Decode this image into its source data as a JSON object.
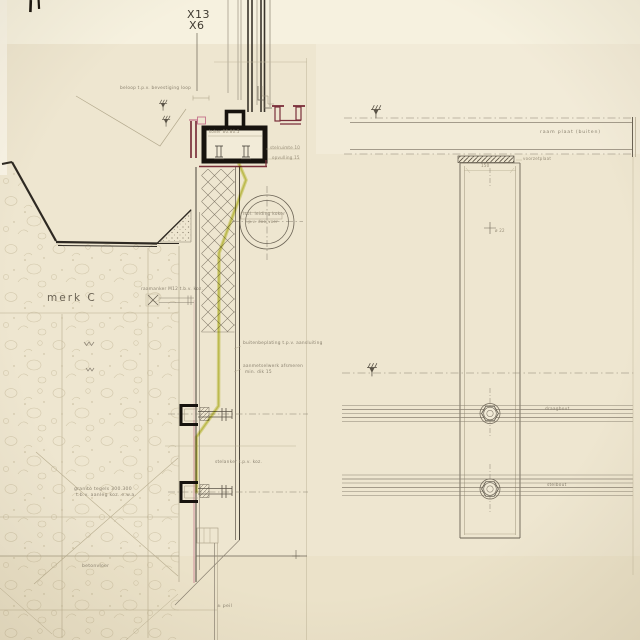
{
  "drawing": {
    "grid_refs": {
      "x13": "X13",
      "x6": "X6"
    },
    "mark": "merk C",
    "notes": {
      "beloop": "beloop t.p.v. bevestiging loop",
      "raamanker": "raamanker M12 t.b.v. koz.",
      "koker": "koker 80.80.5",
      "stelruimte": "stelruimte 10",
      "opvulling": "opvulling 15",
      "duct_line1": "isol. leiding koker",
      "duct_line2": "t.p.v. doorvoer",
      "buitenbeplating": "buitenbeplating t.p.v. aansluiting",
      "aanmetselwerk1": "aanmetselwerk afsmeren",
      "aanmetselwerk2": "min. dik 15",
      "stelanker": "stelanker t.p.v. koz.",
      "granito1": "granito tegels 300.300",
      "granito2": "t.b.v. aanleg koz. e.w.a.",
      "betonvloer": "betonvloer",
      "peil": "± peil",
      "raamplaat": "raam plaat (buiten)",
      "voorzetplaat": "voorzetplaat",
      "dim_150": "150",
      "dia_22": "ø 22",
      "draagbout": "draagbout",
      "stelbout": "stelbout"
    },
    "colors": {
      "paper": "#eee6d0",
      "ink": "#4a443a",
      "black_fill": "#17130e",
      "maroon": "#7a2f3a",
      "pink": "#c4718a",
      "highlight_marker": "#cfd35f"
    }
  }
}
